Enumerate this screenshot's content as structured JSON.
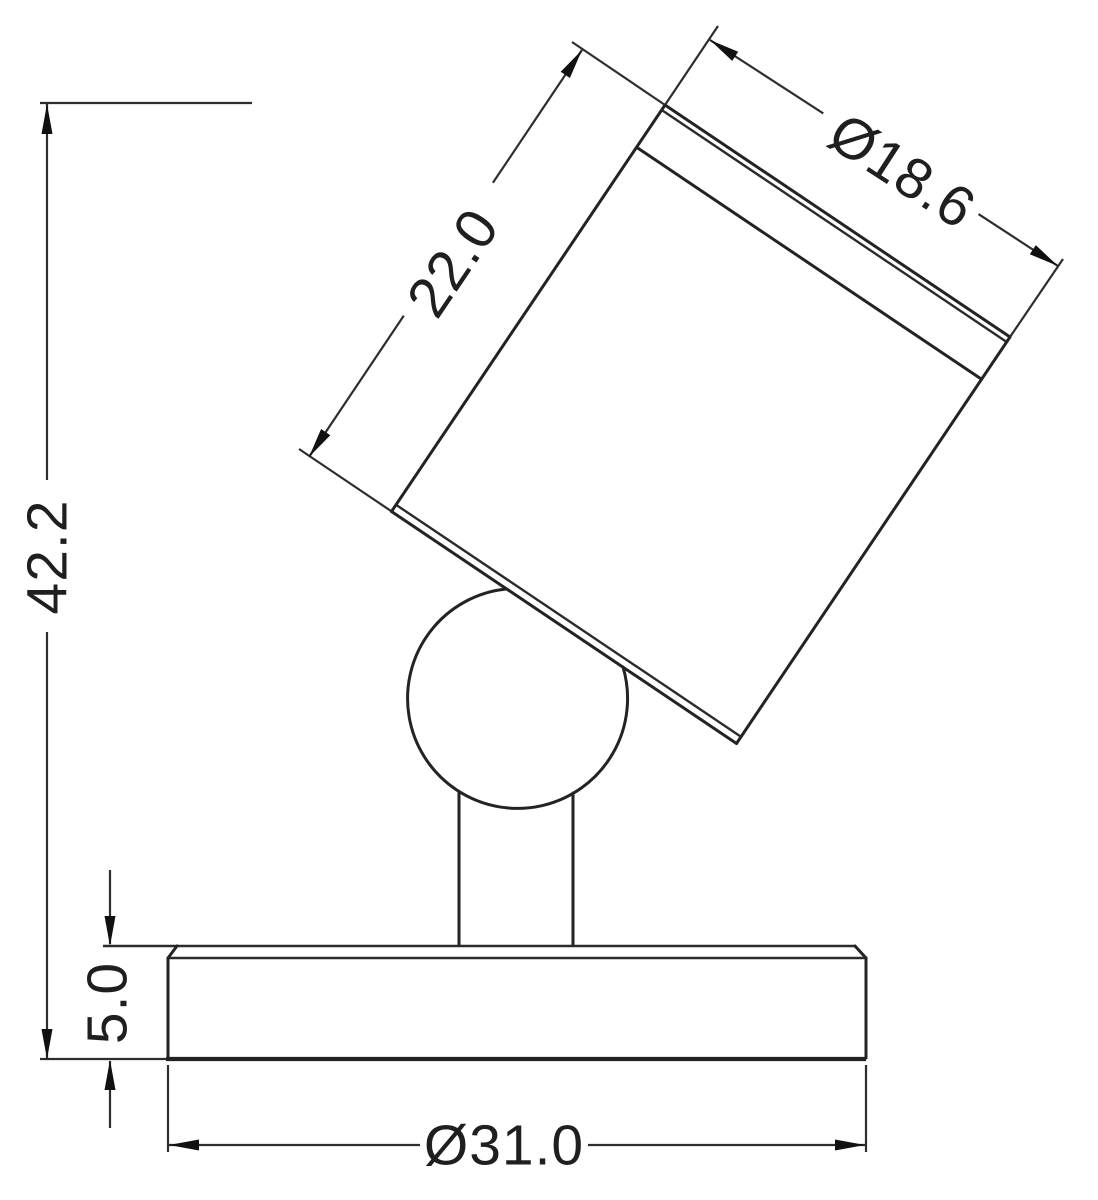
{
  "drawing": {
    "type": "technical-dimension-drawing",
    "subject": "adjustable spotlight side view with ball joint and round base",
    "background_color": "#ffffff",
    "line_color": "#232323",
    "dimensions": {
      "overall_height": {
        "label": "42.2"
      },
      "head_length": {
        "label": "22.0"
      },
      "head_diameter": {
        "label": "Ø18.6"
      },
      "base_thickness": {
        "label": "5.0"
      },
      "base_diameter": {
        "label": "Ø31.0"
      }
    }
  }
}
